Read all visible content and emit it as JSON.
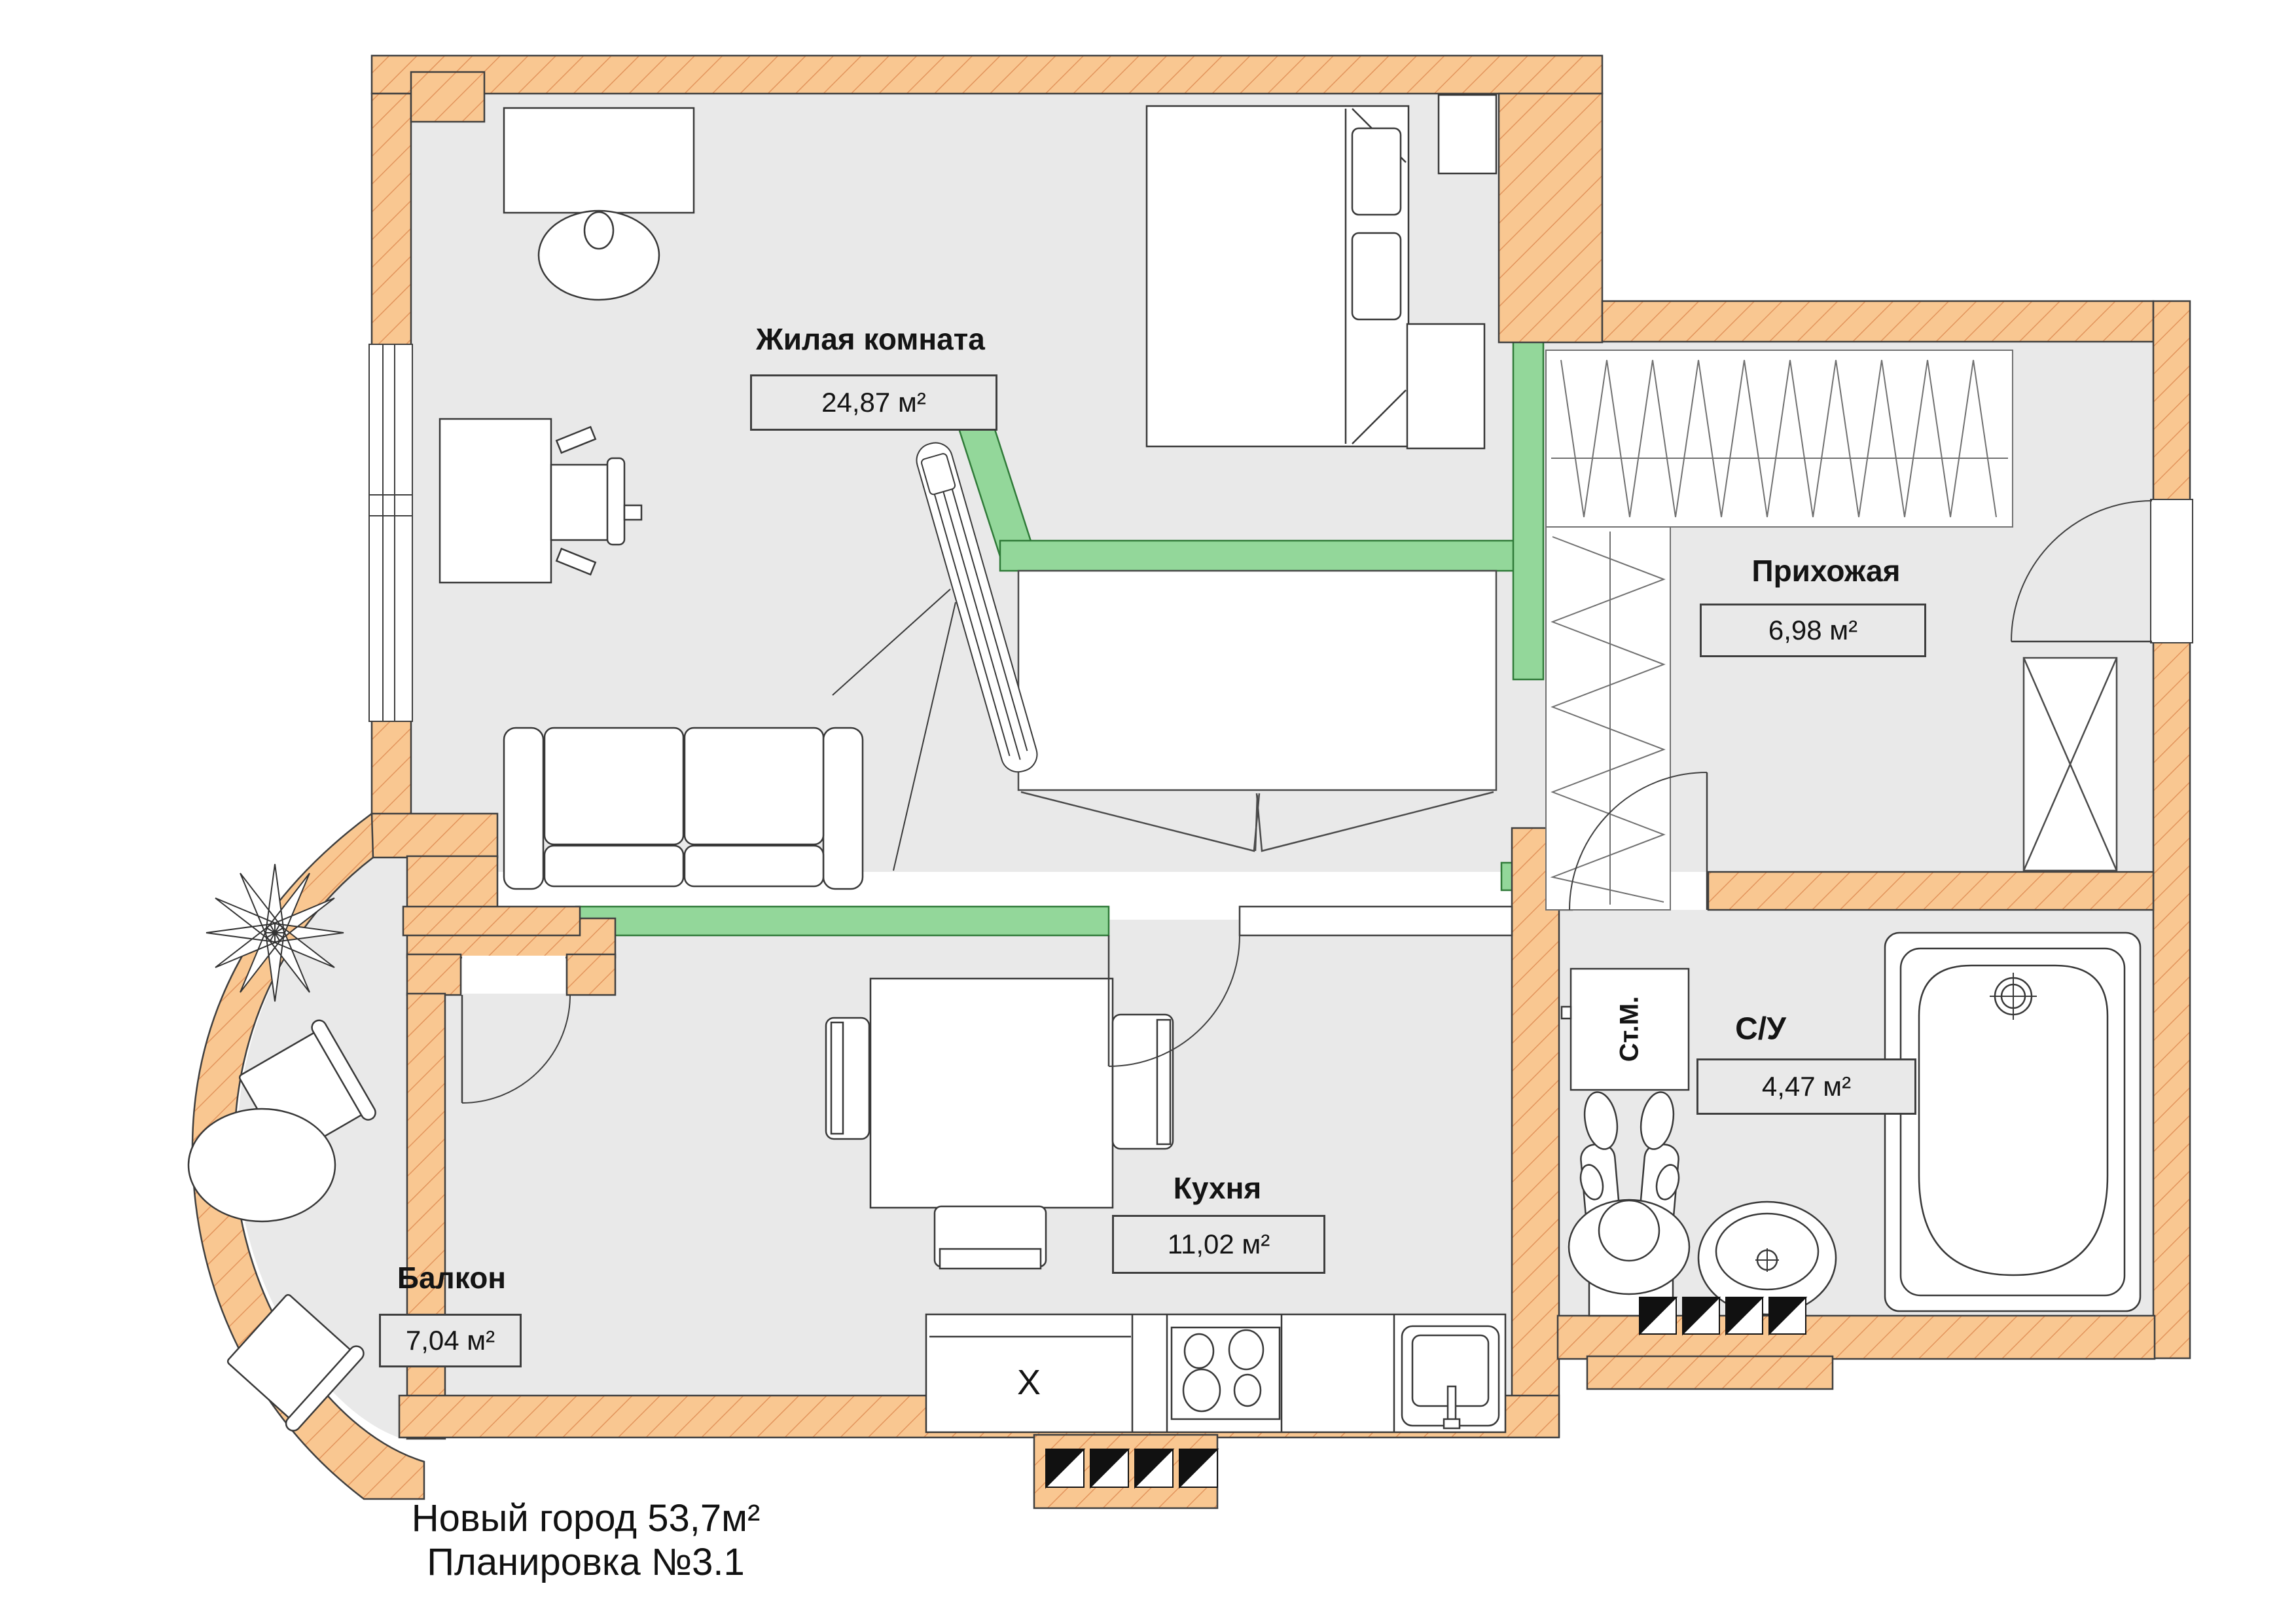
{
  "plan": {
    "floor_title": {
      "line1": "Новый город 53,7м²",
      "line2": "Планировка №3.1"
    },
    "rooms": {
      "living": {
        "name": "Жилая комната",
        "area": "24,87 м²"
      },
      "hallway": {
        "name": "Прихожая",
        "area": "6,98 м²"
      },
      "kitchen": {
        "name": "Кухня",
        "area": "11,02 м²"
      },
      "balcony": {
        "name": "Балкон",
        "area": "7,04 м²"
      },
      "bathroom": {
        "name": "С/У",
        "area": "4,47 м²"
      }
    },
    "appliances": {
      "washing_machine": "Ст.М.",
      "fridge_mark": "X"
    },
    "colors": {
      "outer_wall": "#f9c791",
      "wall_hatch": "#e2945c",
      "partition_green": "#93d79a",
      "floor": "#e9e9e9",
      "line": "#3f3f3f"
    }
  }
}
